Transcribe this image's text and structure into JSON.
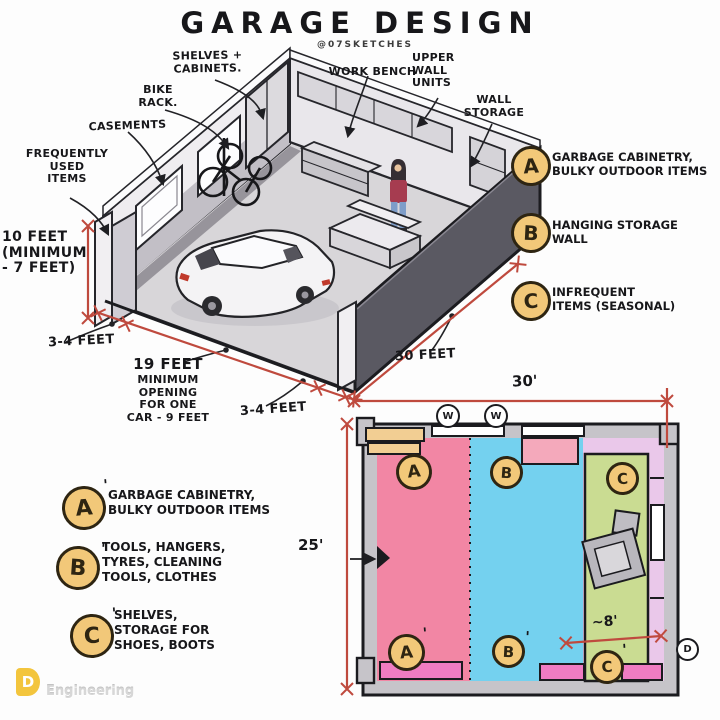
{
  "title": "GARAGE DESIGN",
  "credit": "@07SKETCHES",
  "iso": {
    "labels": {
      "shelves": "SHELVES +\nCABINETS.",
      "bike_rack": "BIKE\nRACK.",
      "casements": "CASEMENTS",
      "frequently_used": "FREQUENTLY\nUSED\nITEMS",
      "work_bench": "WORK BENCH",
      "upper_wall_units": "UPPER\nWALL\nUNITS",
      "wall_storage": "WALL\nSTORAGE"
    },
    "dims": {
      "height": "10 FEET\n(MINIMUM\n- 7 FEET)",
      "side_left": "3-4 FEET",
      "opening_title": "19 FEET",
      "opening_rest": "MINIMUM\nOPENING\nFOR ONE\nCAR - 9 FEET",
      "side_right": "3-4 FEET",
      "depth": "30 FEET"
    }
  },
  "legend_right": [
    {
      "letter": "A",
      "prime": "",
      "text": "GARBAGE CABINETRY,\nBULKY OUTDOOR ITEMS"
    },
    {
      "letter": "B",
      "prime": "",
      "text": "HANGING STORAGE\nWALL"
    },
    {
      "letter": "C",
      "prime": "",
      "text": "INFREQUENT\nITEMS (SEASONAL)"
    }
  ],
  "legend_left": [
    {
      "letter": "A",
      "prime": "'",
      "text": "GARBAGE CABINETRY,\nBULKY OUTDOOR ITEMS"
    },
    {
      "letter": "B",
      "prime": "'",
      "text": "TOOLS, HANGERS,\nTYRES, CLEANING\nTOOLS, CLOTHES"
    },
    {
      "letter": "C",
      "prime": "'",
      "text": "SHELVES,\nSTORAGE FOR\nSHOES, BOOTS"
    }
  ],
  "plan": {
    "width_dim": "30'",
    "height_dim": "25'",
    "zone_c_dim": "~8'",
    "window_label": "W",
    "door_label": "D",
    "badges_top": [
      {
        "letter": "A",
        "prime": ""
      },
      {
        "letter": "B",
        "prime": ""
      },
      {
        "letter": "C",
        "prime": ""
      }
    ],
    "badges_bottom": [
      {
        "letter": "A",
        "prime": "'"
      },
      {
        "letter": "B",
        "prime": "'"
      },
      {
        "letter": "C",
        "prime": "'"
      }
    ],
    "colors": {
      "zone_a": "#f286a4",
      "zone_b": "#74d1ef",
      "zone_c": "#cadc92",
      "cabinet": "#f2ce93",
      "storage": "#ef7cc2",
      "side_strip": "#eac8ea",
      "badge": "#f2c879",
      "dimension": "#bf4a3e"
    }
  },
  "watermark": {
    "logo": "D",
    "text": "Engineering"
  }
}
